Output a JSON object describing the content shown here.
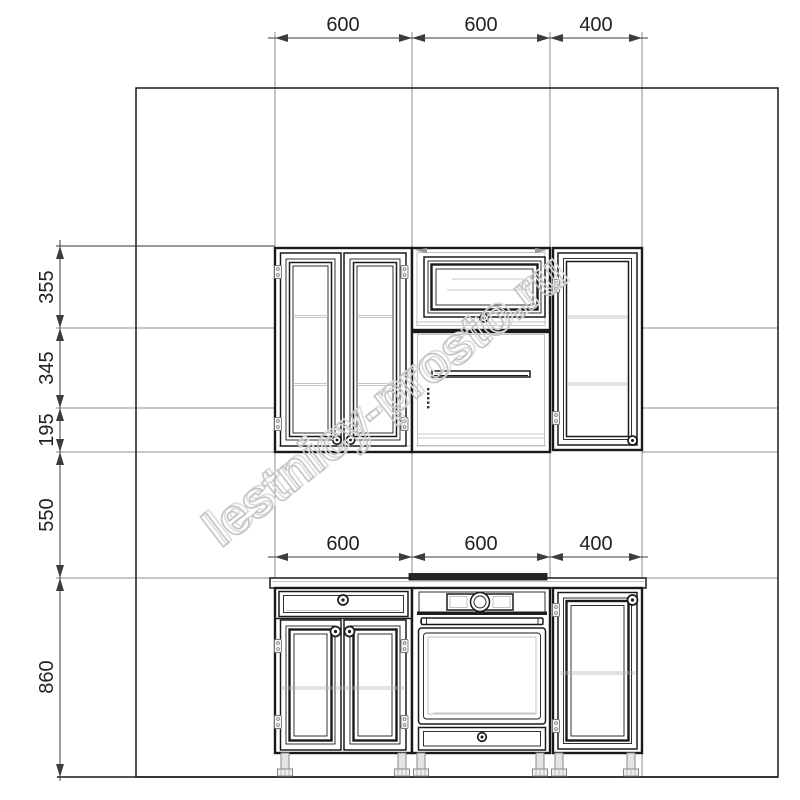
{
  "watermark": {
    "text": "lestnicy-prosto.ru"
  },
  "dimensions": {
    "top": [
      "600",
      "600",
      "400"
    ],
    "middle": [
      "600",
      "600",
      "400"
    ],
    "left": [
      "355",
      "345",
      "195",
      "550",
      "860"
    ]
  },
  "colors": {
    "line_dark": "#1a1a1a",
    "reference_line": "#8c8c8c",
    "line_faint": "#b4b4b4",
    "dimension_line": "#3c3c3c",
    "dimension_text": "#222222",
    "watermark_gray": "#c5c5c5",
    "hob_dark": "#262626",
    "leg_gray": "#e4e4e4",
    "background": "#ffffff"
  }
}
